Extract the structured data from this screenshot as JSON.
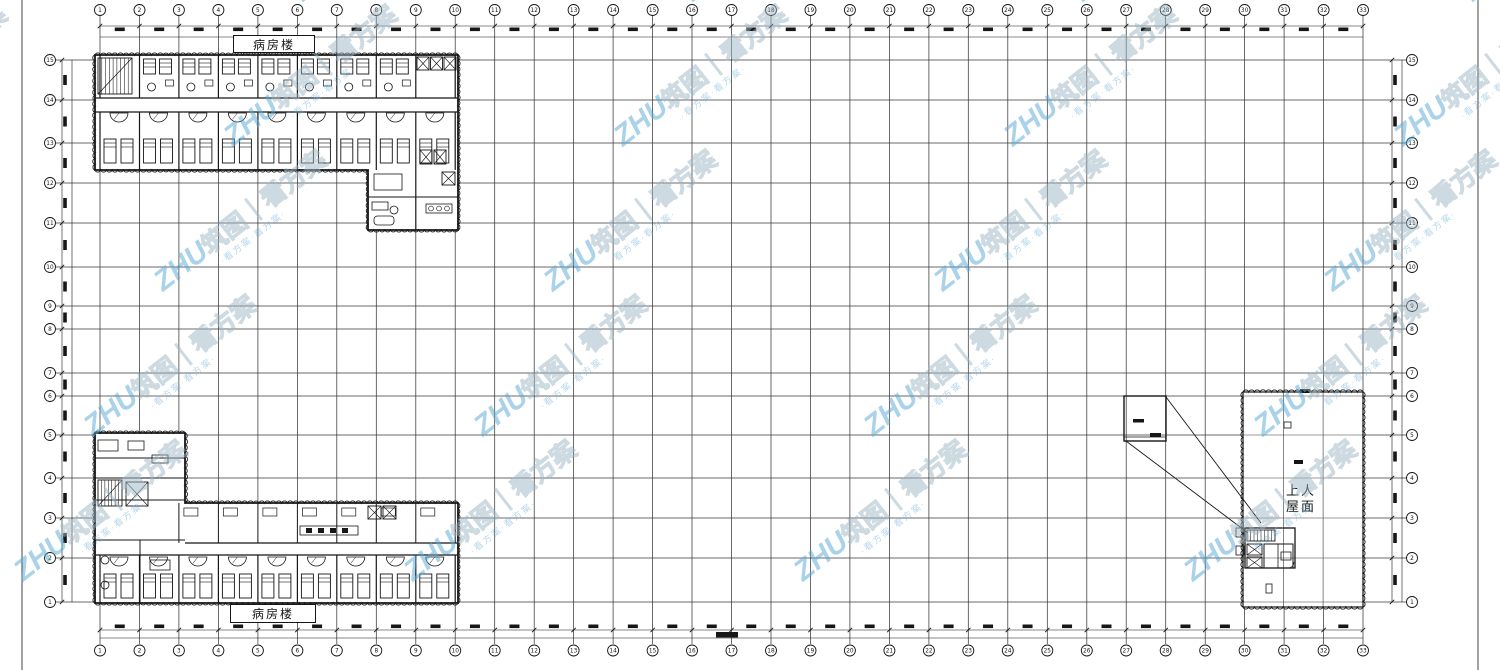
{
  "drawing": {
    "ward_label_top": "病房楼",
    "ward_label_bottom": "病房楼",
    "roof_label_line1": "上人",
    "roof_label_line2": "屋面"
  },
  "axes": {
    "top": [
      "1",
      "2",
      "3",
      "4",
      "5",
      "6",
      "7",
      "8",
      "9",
      "10",
      "11",
      "12",
      "13",
      "14",
      "15",
      "16",
      "17",
      "18",
      "19",
      "20",
      "21",
      "22",
      "23",
      "24",
      "25",
      "26",
      "27",
      "28",
      "29",
      "30",
      "31",
      "32",
      "33"
    ],
    "bottom": [
      "1",
      "2",
      "3",
      "4",
      "5",
      "6",
      "7",
      "8",
      "9",
      "10",
      "11",
      "12",
      "13",
      "14",
      "15",
      "16",
      "17",
      "18",
      "19",
      "20",
      "21",
      "22",
      "23",
      "24",
      "25",
      "26",
      "27",
      "28",
      "29",
      "30",
      "31",
      "32",
      "33"
    ],
    "left": [
      "15",
      "14",
      "13",
      "12",
      "11",
      "10",
      "9",
      "8",
      "7",
      "6",
      "5",
      "4",
      "3",
      "2",
      "1"
    ],
    "right": [
      "15",
      "14",
      "13",
      "12",
      "11",
      "10",
      "9",
      "8",
      "7",
      "6",
      "5",
      "4",
      "3",
      "2",
      "1"
    ]
  },
  "watermark": {
    "brand": "ZHU",
    "brand_cn": "筑图",
    "separator": "｜",
    "slogan": "看方案",
    "tagline": "·看方案·看方案·",
    "brand_color": "#58a8d5",
    "outline_color": "#9fb6c4"
  },
  "colors": {
    "ink": "#161616",
    "grid": "#383838",
    "background": "#ffffff"
  }
}
